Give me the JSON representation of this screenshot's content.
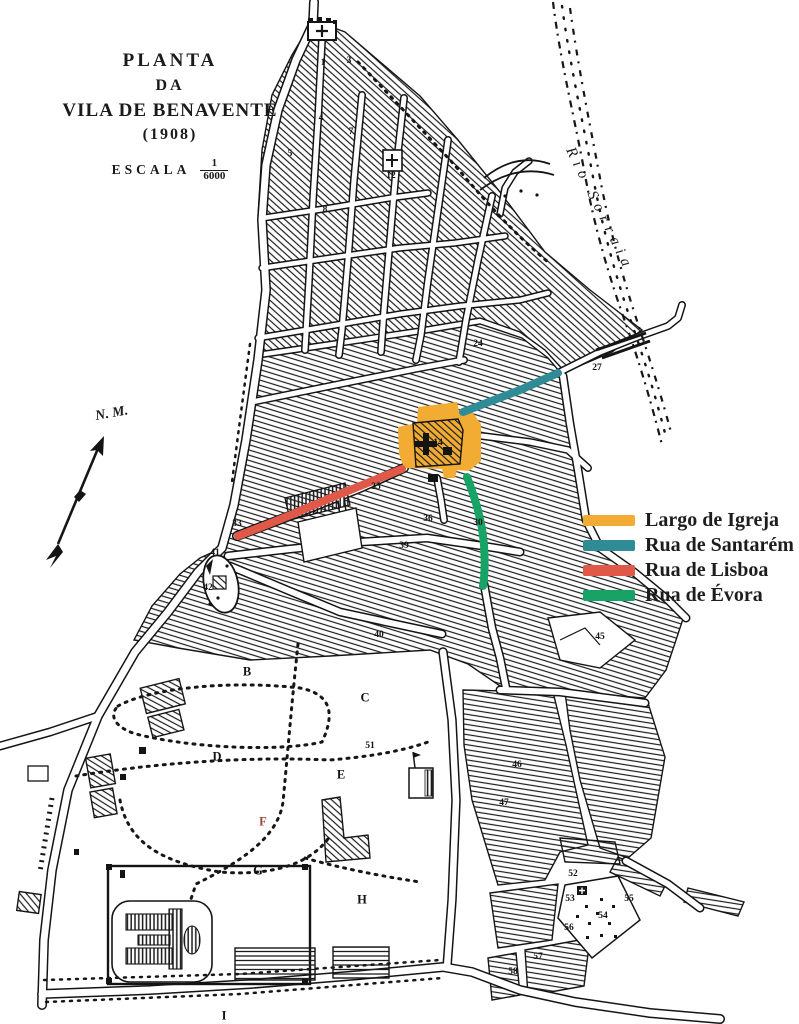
{
  "title": {
    "line1": "PLANTA",
    "line2": "DA",
    "line3": "VILA DE BENAVENTE",
    "line4": "(1908)"
  },
  "scale": {
    "label": "ESCALA",
    "numerator": "1",
    "denominator": "6000"
  },
  "compass": {
    "label": "N. M."
  },
  "river": {
    "label": "Rio Sorraia"
  },
  "legend": {
    "items": [
      {
        "label": "Largo de Igreja",
        "color": "#F2AC34"
      },
      {
        "label": "Rua de Santarém",
        "color": "#2F8C96"
      },
      {
        "label": "Rua de Lisboa",
        "color": "#DF5848"
      },
      {
        "label": "Rua de Évora",
        "color": "#17A266"
      }
    ]
  },
  "map": {
    "ink": "#1a1a1a",
    "paper": "#ffffff",
    "number_labels": [
      {
        "text": "1",
        "x": 323,
        "y": 63
      },
      {
        "text": "3",
        "x": 349,
        "y": 61
      },
      {
        "text": "4",
        "x": 321,
        "y": 118
      },
      {
        "text": "5",
        "x": 290,
        "y": 154
      },
      {
        "text": "7",
        "x": 351,
        "y": 132
      },
      {
        "text": "8",
        "x": 325,
        "y": 210
      },
      {
        "text": "12",
        "x": 391,
        "y": 176
      },
      {
        "text": "24",
        "x": 478,
        "y": 344
      },
      {
        "text": "27",
        "x": 597,
        "y": 368
      },
      {
        "text": "14",
        "x": 438,
        "y": 443
      },
      {
        "text": "33",
        "x": 237,
        "y": 524
      },
      {
        "text": "35",
        "x": 376,
        "y": 487
      },
      {
        "text": "36",
        "x": 428,
        "y": 519
      },
      {
        "text": "30",
        "x": 478,
        "y": 523
      },
      {
        "text": "39",
        "x": 404,
        "y": 546
      },
      {
        "text": "41",
        "x": 215,
        "y": 553
      },
      {
        "text": "42",
        "x": 208,
        "y": 588
      },
      {
        "text": "40",
        "x": 379,
        "y": 635
      },
      {
        "text": "45",
        "x": 600,
        "y": 637
      },
      {
        "text": "51",
        "x": 370,
        "y": 746
      },
      {
        "text": "46",
        "x": 517,
        "y": 765
      },
      {
        "text": "47",
        "x": 504,
        "y": 803
      },
      {
        "text": "52",
        "x": 573,
        "y": 874
      },
      {
        "text": "53",
        "x": 570,
        "y": 899
      },
      {
        "text": "55",
        "x": 629,
        "y": 899
      },
      {
        "text": "54",
        "x": 603,
        "y": 916
      },
      {
        "text": "56",
        "x": 569,
        "y": 928
      },
      {
        "text": "57",
        "x": 538,
        "y": 957
      },
      {
        "text": "58",
        "x": 513,
        "y": 972
      }
    ],
    "letter_labels": [
      {
        "text": "B",
        "x": 247,
        "y": 672
      },
      {
        "text": "C",
        "x": 365,
        "y": 698
      },
      {
        "text": "D",
        "x": 217,
        "y": 757
      },
      {
        "text": "E",
        "x": 341,
        "y": 775
      },
      {
        "text": "F",
        "x": 263,
        "y": 822,
        "color": "#9b4a33"
      },
      {
        "text": "G",
        "x": 258,
        "y": 871
      },
      {
        "text": "H",
        "x": 362,
        "y": 900
      },
      {
        "text": "I",
        "x": 224,
        "y": 1016
      }
    ]
  }
}
